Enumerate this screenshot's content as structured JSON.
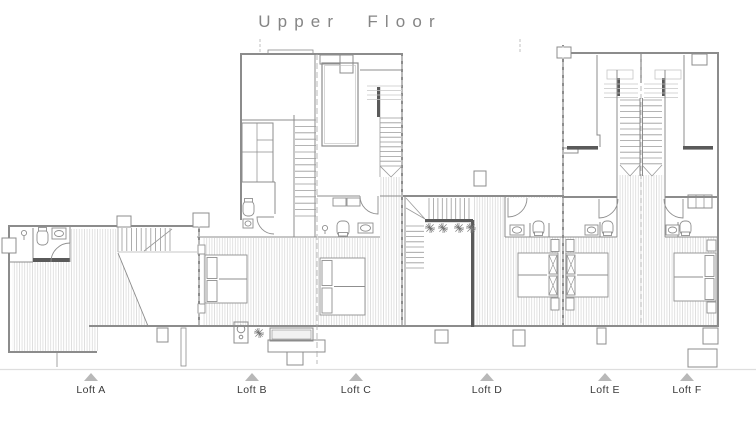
{
  "title": "Upper Floor",
  "lofts": [
    {
      "label": "Loft A"
    },
    {
      "label": "Loft B"
    },
    {
      "label": "Loft C"
    },
    {
      "label": "Loft D"
    },
    {
      "label": "Loft E"
    },
    {
      "label": "Loft F"
    }
  ],
  "colors": {
    "wall": "#8c8c8c",
    "wall_dark": "#5a5a5a",
    "hatch": "#cdcdcd",
    "title_text": "#858585",
    "label_text": "#3a3a3a",
    "marker_triangle": "#b8b8b8",
    "ground_line": "#dedede"
  }
}
